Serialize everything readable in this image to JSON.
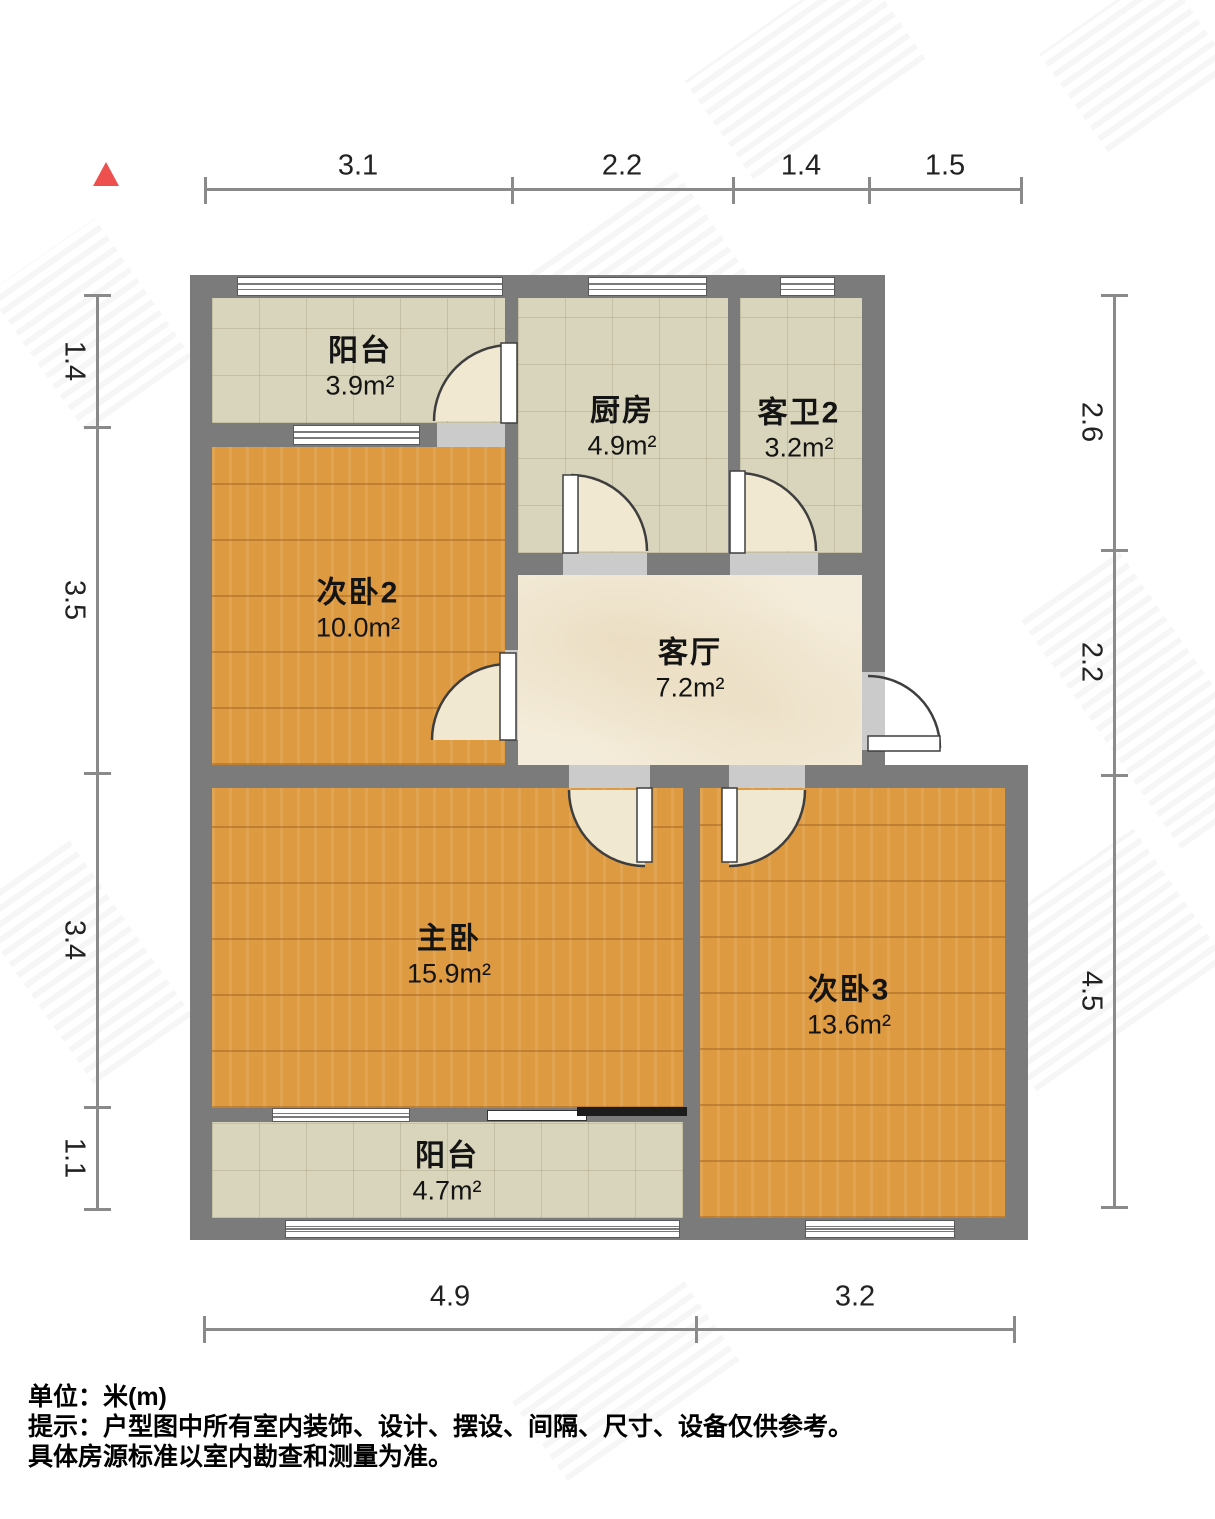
{
  "title": "户型图",
  "north_indicator": {
    "shape": "triangle",
    "color": "#ee4f4f"
  },
  "rooms": {
    "balcony_top": {
      "name": "阳台",
      "area": "3.9m²",
      "floor": "tile"
    },
    "kitchen": {
      "name": "厨房",
      "area": "4.9m²",
      "floor": "tile"
    },
    "bath2": {
      "name": "客卫2",
      "area": "3.2m²",
      "floor": "tile"
    },
    "bedroom2": {
      "name": "次卧2",
      "area": "10.0m²",
      "floor": "wood"
    },
    "living": {
      "name": "客厅",
      "area": "7.2m²",
      "floor": "marble"
    },
    "master": {
      "name": "主卧",
      "area": "15.9m²",
      "floor": "wood"
    },
    "bedroom3": {
      "name": "次卧3",
      "area": "13.6m²",
      "floor": "wood"
    },
    "balcony_bottom": {
      "name": "阳台",
      "area": "4.7m²",
      "floor": "tile"
    }
  },
  "dimensions": {
    "unit": "米(m)",
    "top": [
      "3.1",
      "2.2",
      "1.4",
      "1.5"
    ],
    "left": [
      "1.4",
      "3.5",
      "3.4",
      "1.1"
    ],
    "right": [
      "2.6",
      "2.2",
      "4.5"
    ],
    "bottom": [
      "4.9",
      "3.2"
    ]
  },
  "footer": {
    "lines": [
      "单位：米(m)",
      "提示：户型图中所有室内装饰、设计、摆设、间隔、尺寸、设备仅供参考。",
      "具体房源标准以室内勘查和测量为准。"
    ]
  },
  "colors": {
    "wall": "#7b7b7b",
    "wood_floor": "#dd9a41",
    "tile_floor": "#d9d5bc",
    "marble_floor": "#f4ecda",
    "north_arrow": "#ee4f4f",
    "dimension_line": "#8a8a8a"
  }
}
